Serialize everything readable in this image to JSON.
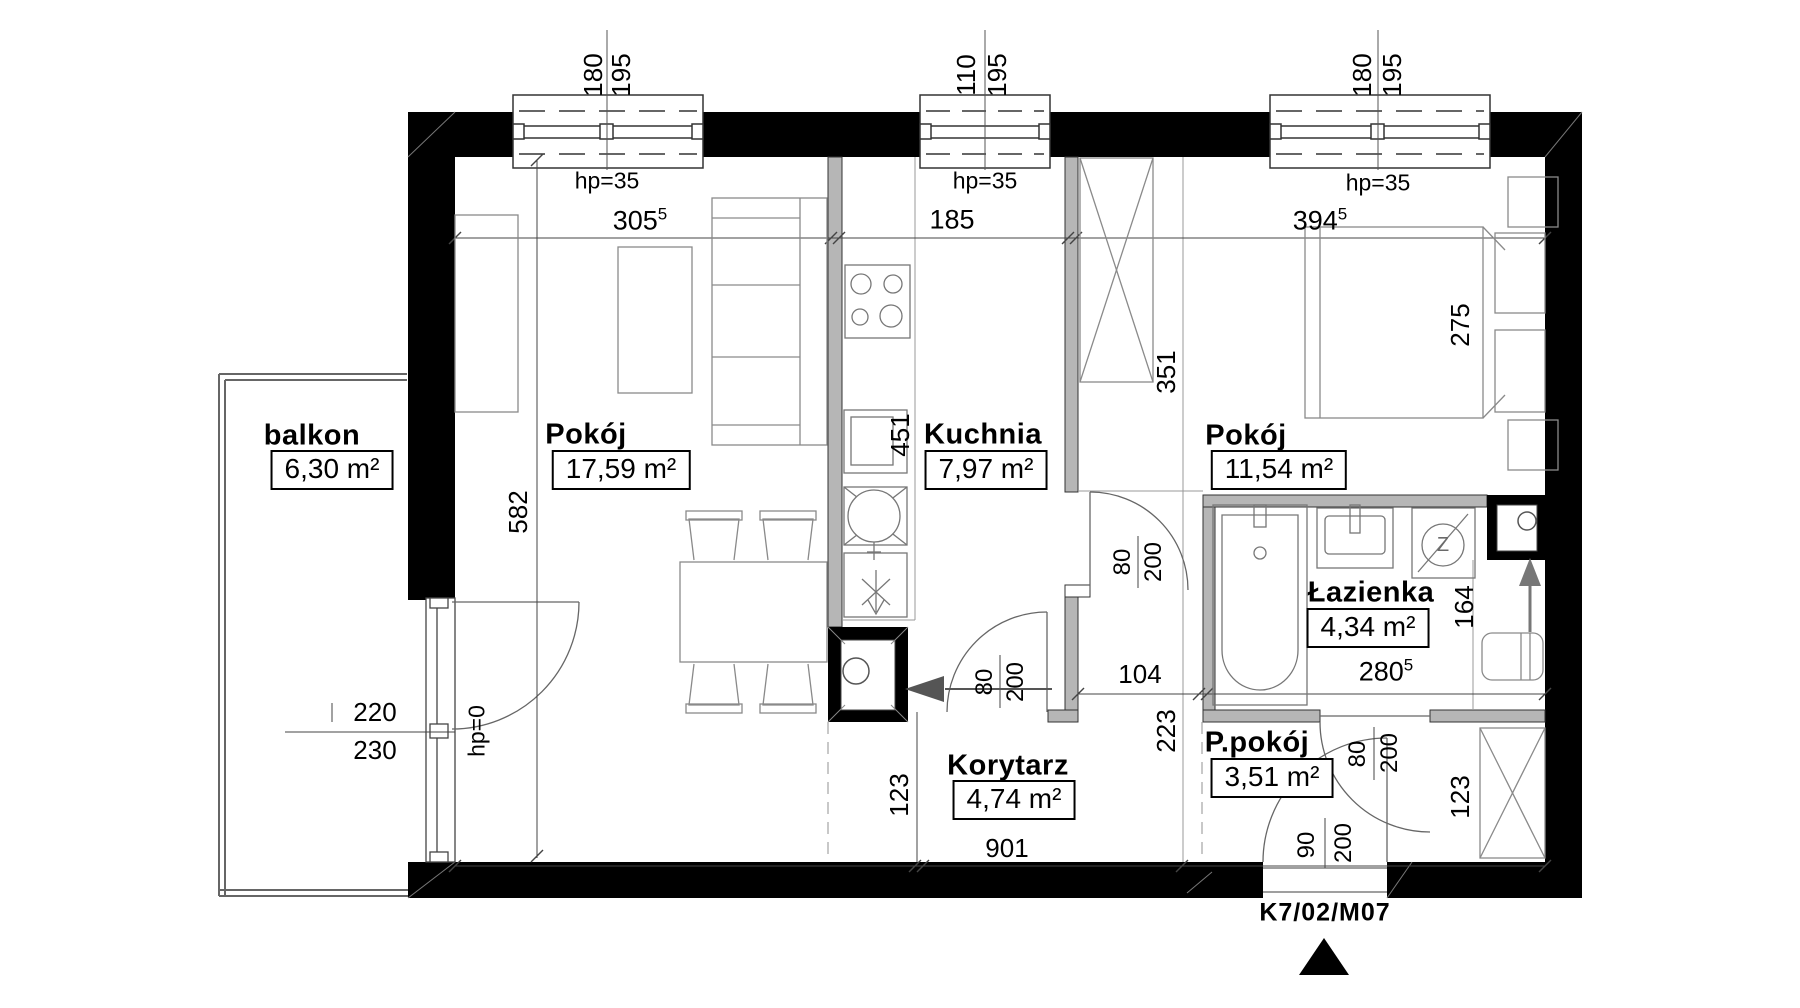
{
  "unit": {
    "label": "K7/02/M07"
  },
  "rooms": {
    "balkon": {
      "name": "balkon",
      "area": "6,30 m²"
    },
    "livingroom": {
      "name": "Pokój",
      "area": "17,59 m²"
    },
    "kitchen": {
      "name": "Kuchnia",
      "area": "7,97 m²"
    },
    "bedroom": {
      "name": "Pokój",
      "area": "11,54 m²"
    },
    "bathroom": {
      "name": "Łazienka",
      "area": "4,34 m²"
    },
    "corridor": {
      "name": "Korytarz",
      "area": "4,74 m²"
    },
    "utility": {
      "name": "P.pokój",
      "area": "3,51 m²"
    }
  },
  "windows": {
    "left": {
      "width": "180",
      "height": "195",
      "sill": "hp=35"
    },
    "middle": {
      "width": "110",
      "height": "195",
      "sill": "hp=35"
    },
    "right": {
      "width": "180",
      "height": "195",
      "sill": "hp=35"
    }
  },
  "doors": {
    "balcony": {
      "width": "220",
      "height": "230",
      "sill": "hp=0"
    },
    "kitchen": {
      "width": "80",
      "height": "200"
    },
    "hall": {
      "width": "80",
      "height": "200"
    },
    "bathroom": {
      "width": "80",
      "height": "200"
    },
    "entrance": {
      "width": "90",
      "height": "200"
    }
  },
  "dimensions": {
    "living_width": {
      "value": "305",
      "sup": "5"
    },
    "kitchen_width": "185",
    "bedroom_width": {
      "value": "394",
      "sup": "5"
    },
    "living_height": "582",
    "kitchen_length": "451",
    "wardrobe_length": "351",
    "bed_length": "275",
    "hall_width": "104",
    "bathroom_width": {
      "value": "280",
      "sup": "5"
    },
    "utility_height": "223",
    "washer_nook": "164",
    "corridor_width": "123",
    "vestibule_width": "123",
    "total_width": "901"
  },
  "icons": {
    "washer_glyph": "Z"
  }
}
